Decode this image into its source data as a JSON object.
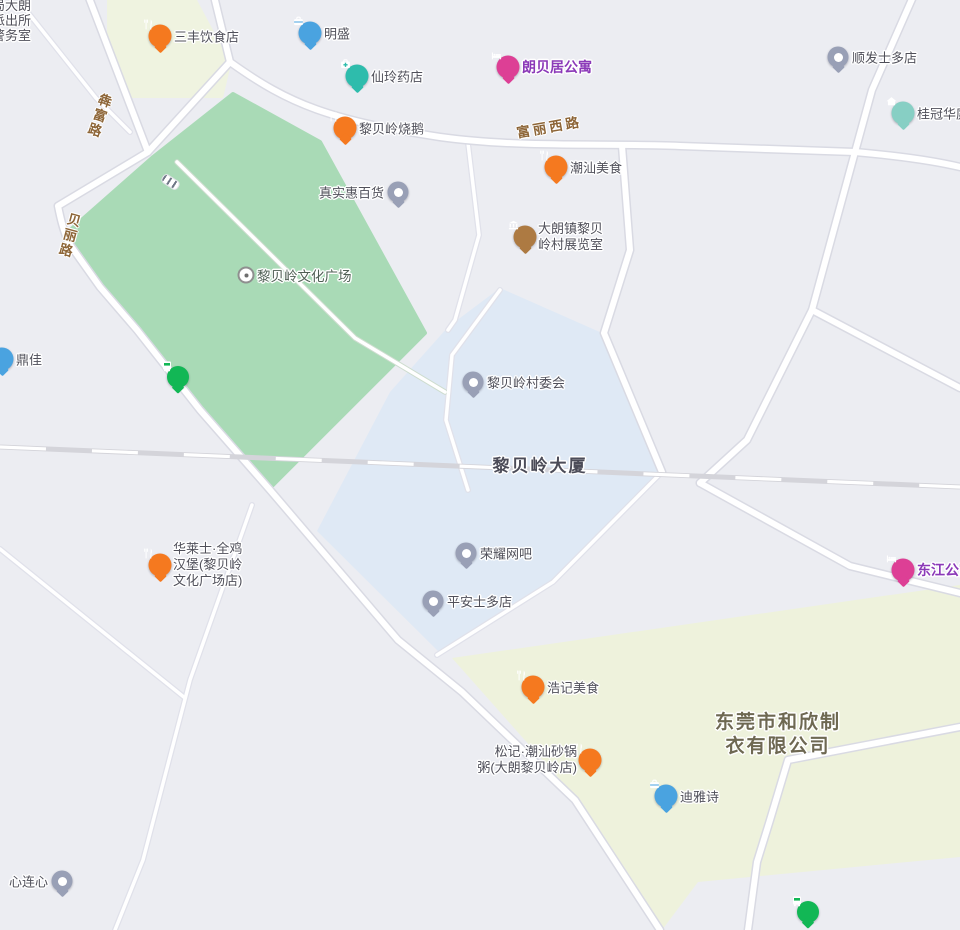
{
  "map": {
    "background": "#ecedf2",
    "colors": {
      "park": "#a9dab6",
      "block_top_left": "#eff3e0",
      "block_building_area": "#dfe9f5",
      "block_industrial": "#eef2dc",
      "road_fill": "#ffffff",
      "road_casing": "#d9dae3",
      "railway": "#d4d4da",
      "poi_label": "#50505a",
      "road_label": "#8d6537",
      "apartment_label": "#8b39b8",
      "pin_food": "#f5791f",
      "pin_business": "#4aa3e0",
      "pin_pharmacy": "#2ebcac",
      "pin_hotel": "#dd3f95",
      "pin_generic": "#99a0b6",
      "pin_museum": "#ad7a42",
      "pin_house": "#87cfc4",
      "pin_bus": "#12b755"
    },
    "road_labels": [
      {
        "text": "犇富路",
        "orientation": "vertical"
      },
      {
        "text": "贝丽路",
        "orientation": "vertical"
      },
      {
        "text": "富丽西路",
        "orientation": "horizontal"
      }
    ],
    "area_labels": {
      "police_lines": [
        "局大朗",
        "派出所",
        "警务室"
      ],
      "culture_square": "黎贝岭文化广场",
      "building": "黎贝岭大厦",
      "factory_lines": [
        "东莞市和欣制",
        "衣有限公司"
      ]
    },
    "pois": [
      {
        "label": "三丰饮食店",
        "type": "restaurant"
      },
      {
        "label": "明盛",
        "type": "business"
      },
      {
        "label": "仙玲药店",
        "type": "pharmacy"
      },
      {
        "label": "朗贝居公寓",
        "type": "apartment"
      },
      {
        "label": "顺发士多店",
        "type": "shop"
      },
      {
        "label": "桂冠华庭",
        "type": "residence"
      },
      {
        "label": "黎贝岭烧鹅",
        "type": "restaurant"
      },
      {
        "label": "真实惠百货",
        "type": "shop"
      },
      {
        "label": "潮汕美食",
        "type": "restaurant"
      },
      {
        "lines": [
          "大朗镇黎贝",
          "岭村展览室"
        ],
        "type": "museum"
      },
      {
        "label": "鼎佳",
        "type": "business"
      },
      {
        "type": "bus-stop"
      },
      {
        "label": "黎贝岭村委会",
        "type": "government"
      },
      {
        "lines": [
          "华莱士·全鸡",
          "汉堡(黎贝岭",
          "文化广场店)"
        ],
        "type": "restaurant"
      },
      {
        "label": "荣耀网吧",
        "type": "internet-cafe"
      },
      {
        "label": "平安士多店",
        "type": "shop"
      },
      {
        "label": "东江公寓",
        "type": "apartment"
      },
      {
        "label": "浩记美食",
        "type": "restaurant"
      },
      {
        "lines": [
          "松记·潮汕砂锅",
          "粥(大朗黎贝岭店)"
        ],
        "type": "restaurant"
      },
      {
        "label": "迪雅诗",
        "type": "business"
      },
      {
        "label": "心连心",
        "type": "shop"
      },
      {
        "type": "bus-stop"
      }
    ]
  }
}
